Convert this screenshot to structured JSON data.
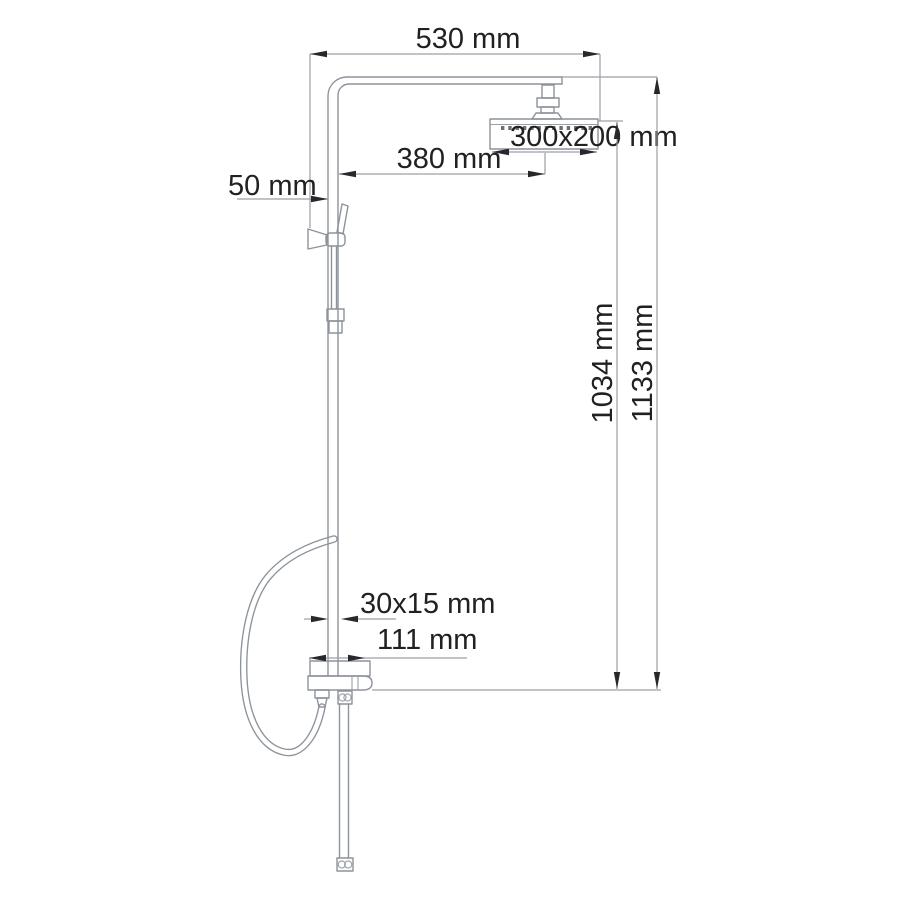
{
  "drawing": {
    "subject": "shower-column-dimension-drawing",
    "colors": {
      "background": "#ffffff",
      "outline": "#8d939b",
      "dimension_line": "#9aa0a6",
      "arrow": "#26282b",
      "text": "#212121"
    },
    "labels": {
      "width_top": "530 mm",
      "head_size": "300x200 mm",
      "arm_reach": "380 mm",
      "wall_offset": "50 mm",
      "height_inner": "1034 mm",
      "height_outer": "1133 mm",
      "bar_section": "30x15 mm",
      "body_width": "111 mm"
    }
  }
}
